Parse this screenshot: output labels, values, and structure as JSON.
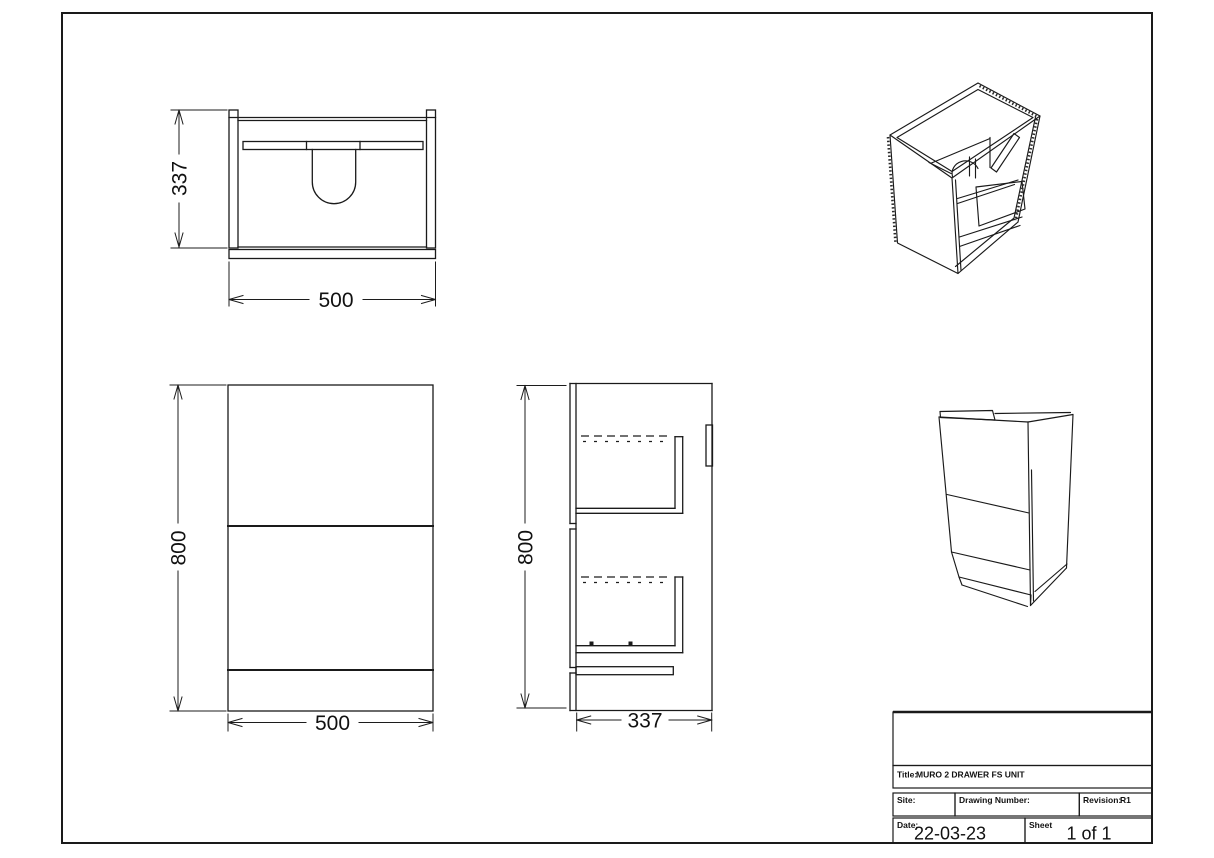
{
  "drawing": {
    "background": "#ffffff",
    "line_color": "#1a1a1a",
    "views": {
      "plan": {
        "depth_dim": "337",
        "width_dim": "500"
      },
      "front": {
        "height_dim": "800",
        "width_dim": "500"
      },
      "side": {
        "height_dim": "800",
        "depth_dim": "337"
      }
    },
    "title_block": {
      "title_label": "Title:",
      "title_value": "MURO 2 DRAWER FS UNIT",
      "site_label": "Site:",
      "drawing_number_label": "Drawing Number:",
      "revision_label": "Revision:",
      "revision_value": "R1",
      "date_label": "Date:",
      "date_value": "22-03-23",
      "sheet_label": "Sheet",
      "sheet_value": "1 of 1"
    }
  }
}
